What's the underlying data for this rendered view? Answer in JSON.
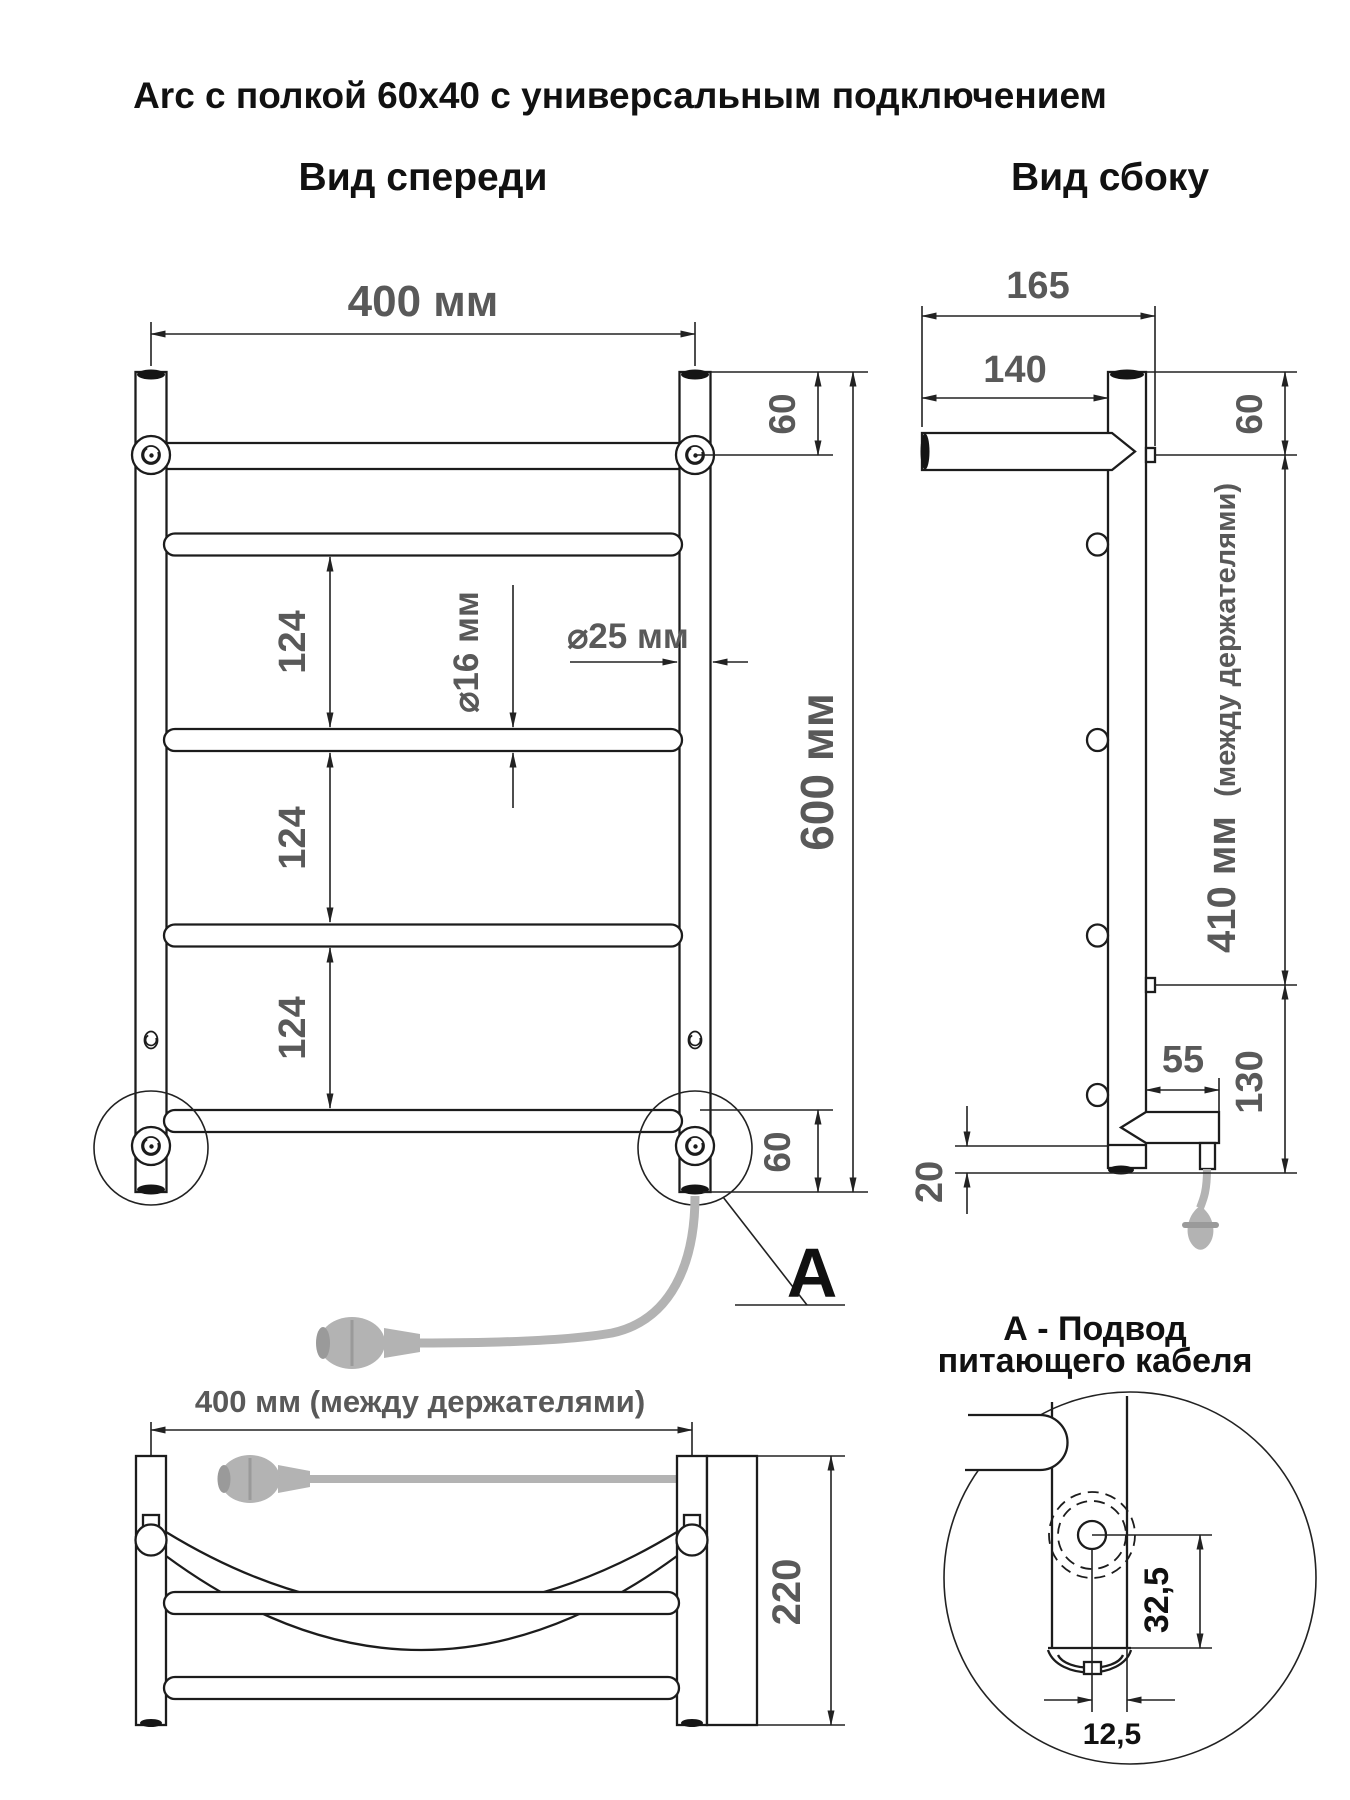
{
  "title": "Arc с полкой 60x40 с универсальным подключением",
  "front_view": {
    "label": "Вид спереди",
    "width_dim": "400 мм",
    "top_offset_dim": "60",
    "rail_spacing_dims": [
      "124",
      "124",
      "124"
    ],
    "rail_diameter_dim": "⌀16 мм",
    "post_diameter_dim": "⌀25 мм",
    "height_dim": "600 мм",
    "bottom_offset_dim": "60",
    "detail_marker": "A"
  },
  "side_view": {
    "label": "Вид сбоку",
    "total_depth_dim": "165",
    "shelf_depth_dim": "140",
    "top_offset_dim": "60",
    "bracket_span_dim": "410 мм",
    "bracket_span_note": "(между держателями)",
    "connector_length_dim": "55",
    "bottom_section_dim": "130",
    "floor_clearance_dim": "20"
  },
  "top_view": {
    "width_dim": "400 мм (между держателями)",
    "depth_dim": "220"
  },
  "detail_a": {
    "title_line1": "А - Подвод",
    "title_line2": "питающего кабеля",
    "hole_center_dim": "32,5",
    "hole_offset_dim": "12,5"
  },
  "colors": {
    "line": "#1c1c1c",
    "dim_text": "#595959",
    "cable": "#b3b3b3"
  }
}
